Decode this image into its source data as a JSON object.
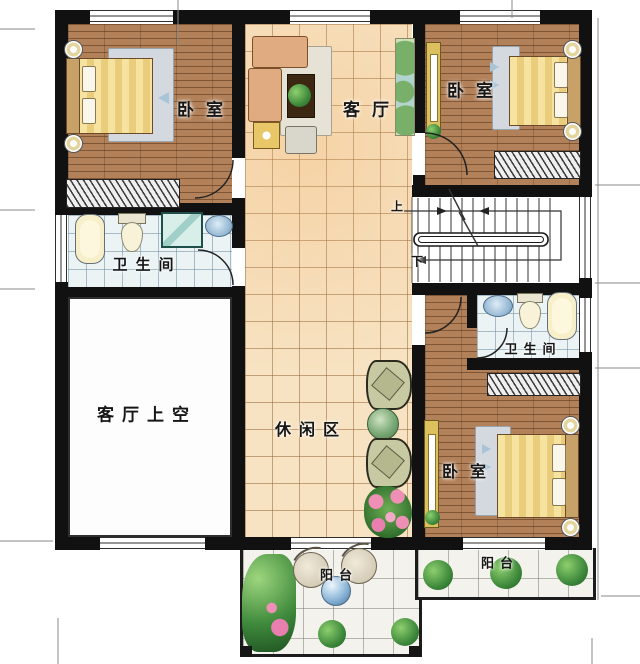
{
  "rooms": {
    "bedroom_tl": "卧室",
    "living": "客厅",
    "bedroom_tr": "卧室",
    "bath_left": "卫生间",
    "living_void": "客厅上空",
    "leisure": "休闲区",
    "bath_right": "卫生间",
    "bedroom_br": "卧室",
    "balcony_left": "阳台",
    "balcony_right": "阳台"
  },
  "stairs": {
    "up": "上",
    "down": "下"
  },
  "colors": {
    "wall": "#111111",
    "wood_floor": "#b2815a",
    "hall_tile": "#f7e2c1",
    "bath_tile": "#ecf3f5",
    "balcony_tile": "#f3f2ec",
    "void_floor": "#fdfdfd",
    "plant_green": "#3f8a3c",
    "flower_pink": "#ef8fb5",
    "rug_blue": "#d3d9df",
    "bed_yellow": "#f2d98c"
  }
}
